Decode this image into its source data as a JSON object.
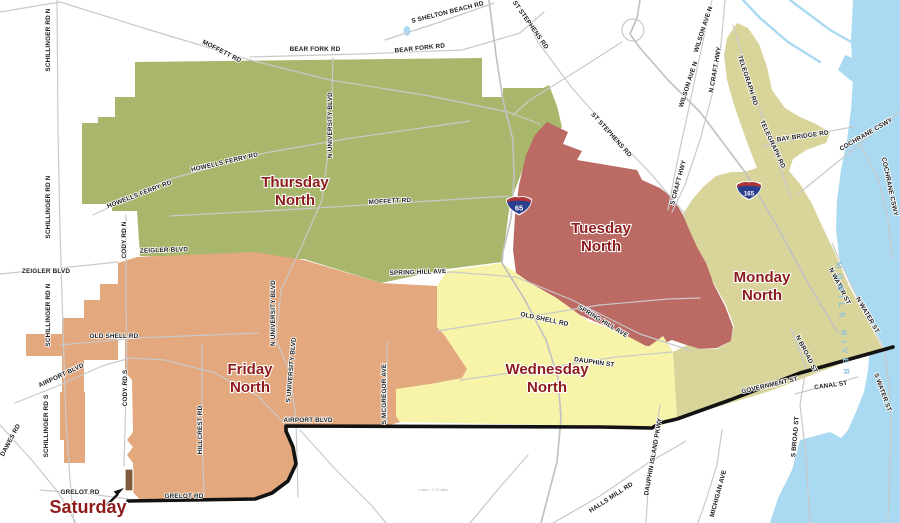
{
  "map_type": "garbage-collection-route-map",
  "colors": {
    "water": "#a9daf2",
    "road": "#c9c9c9",
    "boundary": "#121212",
    "road_label": "#1c1c1c",
    "zone_label": "#8e1b1b",
    "river_label": "#8ec4e0",
    "shield_blue": "#2b3f8f",
    "shield_red": "#b23434"
  },
  "zones": [
    {
      "id": "thursday-north",
      "lines": [
        "Thursday",
        "North"
      ],
      "color": "#a8b76b",
      "label_x": 295,
      "label_y": 187,
      "size": 15
    },
    {
      "id": "tuesday-north",
      "lines": [
        "Tuesday",
        "North"
      ],
      "color": "#bb6a64",
      "label_x": 601,
      "label_y": 233,
      "size": 15
    },
    {
      "id": "monday-north",
      "lines": [
        "Monday",
        "North"
      ],
      "color": "#d8d49a",
      "label_x": 762,
      "label_y": 282,
      "size": 15
    },
    {
      "id": "wednesday-north",
      "lines": [
        "Wednesday",
        "North"
      ],
      "color": "#f7f3a8",
      "label_x": 547,
      "label_y": 374,
      "size": 15
    },
    {
      "id": "friday-north",
      "lines": [
        "Friday",
        "North"
      ],
      "color": "#e3a87e",
      "label_x": 250,
      "label_y": 374,
      "size": 15
    },
    {
      "id": "saturday",
      "lines": [
        "Saturday"
      ],
      "color": "#7d5c3c",
      "label_x": 88,
      "label_y": 513,
      "size": 18
    }
  ],
  "highway_shields": [
    {
      "type": "interstate",
      "number": "65",
      "x": 519,
      "y": 205
    },
    {
      "type": "interstate",
      "number": "165",
      "x": 749,
      "y": 190
    }
  ],
  "water_label": {
    "text": "MOBILE RIVER",
    "x": 836,
    "y": 262,
    "r": 86
  },
  "scale_note": {
    "text": "1 inch = 1.75 miles",
    "x": 433,
    "y": 491
  },
  "road_labels": [
    {
      "text": "SCHILLINGER RD N",
      "x": 50,
      "y": 40,
      "r": -90
    },
    {
      "text": "SCHILLINGER RD N",
      "x": 50,
      "y": 207,
      "r": -90
    },
    {
      "text": "SCHILLINGER RD N",
      "x": 50,
      "y": 315,
      "r": -90
    },
    {
      "text": "SCHILLINGER RD S",
      "x": 48,
      "y": 426,
      "r": -90
    },
    {
      "text": "MOFFETT RD",
      "x": 221,
      "y": 53,
      "r": 27
    },
    {
      "text": "BEAR FORK RD",
      "x": 315,
      "y": 51,
      "r": 0
    },
    {
      "text": "BEAR FORK RD",
      "x": 420,
      "y": 50,
      "r": -6
    },
    {
      "text": "S SHELTON BEACH RD",
      "x": 448,
      "y": 14,
      "r": -14
    },
    {
      "text": "ST STEPHENS RD",
      "x": 529,
      "y": 26,
      "r": 55
    },
    {
      "text": "ST STEPHENS RD",
      "x": 610,
      "y": 136,
      "r": 48
    },
    {
      "text": "WILSON AVE N",
      "x": 705,
      "y": 30,
      "r": -72
    },
    {
      "text": "WILSON AVE N",
      "x": 690,
      "y": 85,
      "r": -72
    },
    {
      "text": "N CRAFT HWY",
      "x": 717,
      "y": 70,
      "r": -80
    },
    {
      "text": "S CRAFT HWY",
      "x": 680,
      "y": 183,
      "r": -75
    },
    {
      "text": "TELEGRAPH RD",
      "x": 746,
      "y": 81,
      "r": 72
    },
    {
      "text": "TELEGRAPH RD",
      "x": 771,
      "y": 145,
      "r": 65
    },
    {
      "text": "BAY BRIDGE RD",
      "x": 803,
      "y": 138,
      "r": -8
    },
    {
      "text": "COCHRANE CSWY",
      "x": 867,
      "y": 136,
      "r": -30
    },
    {
      "text": "COCHRANE CSWY",
      "x": 888,
      "y": 187,
      "r": 78
    },
    {
      "text": "HOWELLS FERRY RD",
      "x": 140,
      "y": 196,
      "r": -21
    },
    {
      "text": "HOWELLS FERRY RD",
      "x": 225,
      "y": 164,
      "r": -13
    },
    {
      "text": "N UNIVERSITY BLVD",
      "x": 332,
      "y": 125,
      "r": -90
    },
    {
      "text": "MOFFETT RD",
      "x": 390,
      "y": 203,
      "r": -3
    },
    {
      "text": "ZEIGLER BLVD",
      "x": 46,
      "y": 273,
      "r": 0
    },
    {
      "text": "ZEIGLER BLVD",
      "x": 164,
      "y": 252,
      "r": -2
    },
    {
      "text": "CODY RD N",
      "x": 126,
      "y": 240,
      "r": -90
    },
    {
      "text": "SPRING HILL AVE",
      "x": 418,
      "y": 274,
      "r": -2
    },
    {
      "text": "SPRING HILL AVE",
      "x": 602,
      "y": 323,
      "r": 31
    },
    {
      "text": "OLD SHELL RD",
      "x": 114,
      "y": 338,
      "r": 0
    },
    {
      "text": "OLD SHELL RD",
      "x": 544,
      "y": 321,
      "r": 12
    },
    {
      "text": "N UNIVERSITY BLVD",
      "x": 275,
      "y": 313,
      "r": -90
    },
    {
      "text": "S UNIVERSITY BLVD",
      "x": 293,
      "y": 370,
      "r": -85
    },
    {
      "text": "CODY RD S",
      "x": 127,
      "y": 388,
      "r": -90
    },
    {
      "text": "AIRPORT BLVD",
      "x": 62,
      "y": 377,
      "r": -25
    },
    {
      "text": "AIRPORT BLVD",
      "x": 308,
      "y": 422,
      "r": 0
    },
    {
      "text": "DAWES RD",
      "x": 12,
      "y": 441,
      "r": -62
    },
    {
      "text": "HILLCREST RD",
      "x": 202,
      "y": 430,
      "r": -90
    },
    {
      "text": "S MCGREGOR AVE",
      "x": 386,
      "y": 394,
      "r": -90
    },
    {
      "text": "DAUPHIN ST",
      "x": 594,
      "y": 364,
      "r": 8
    },
    {
      "text": "GOVERNMENT ST",
      "x": 770,
      "y": 387,
      "r": -13
    },
    {
      "text": "CANAL ST",
      "x": 831,
      "y": 387,
      "r": -8
    },
    {
      "text": "N BROAD ST",
      "x": 805,
      "y": 355,
      "r": 63
    },
    {
      "text": "S BROAD ST",
      "x": 797,
      "y": 437,
      "r": -85
    },
    {
      "text": "N WATER ST",
      "x": 838,
      "y": 287,
      "r": 63
    },
    {
      "text": "N WATER ST",
      "x": 866,
      "y": 316,
      "r": 60
    },
    {
      "text": "S WATER ST",
      "x": 881,
      "y": 393,
      "r": 70
    },
    {
      "text": "DAUPHIN ISLAND PKWY",
      "x": 655,
      "y": 457,
      "r": -80
    },
    {
      "text": "MICHIGAN AVE",
      "x": 720,
      "y": 494,
      "r": -75
    },
    {
      "text": "HALLS MILL RD",
      "x": 612,
      "y": 499,
      "r": -33
    },
    {
      "text": "GRELOT RD",
      "x": 80,
      "y": 494,
      "r": 0
    },
    {
      "text": "GRELOT RD",
      "x": 184,
      "y": 498,
      "r": 0
    }
  ]
}
